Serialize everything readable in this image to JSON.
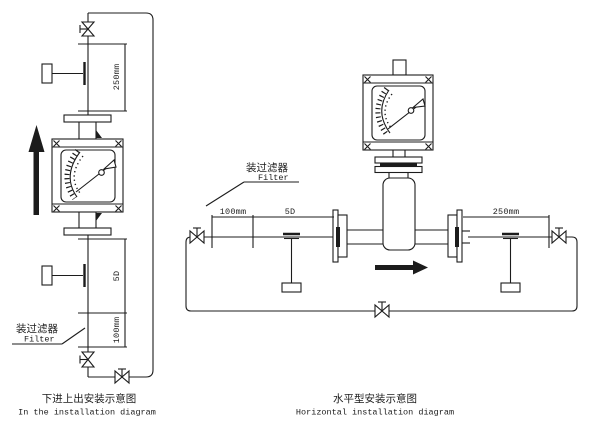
{
  "figure": {
    "type": "flow-meter installation diagram",
    "background": "#ffffff",
    "line_color": "#1c1c1c"
  },
  "left_diagram": {
    "dimensions": {
      "outlet_250": "250mm",
      "inlet_straight_5d": "5D",
      "filter_section_100": "100mm"
    },
    "filter_label": {
      "cn": "装过滤器",
      "en": "Filter"
    },
    "caption": {
      "cn": "下进上出安装示意图",
      "en": "In the installation diagram"
    }
  },
  "right_diagram": {
    "dimensions": {
      "inlet_filter_100": "100mm",
      "inlet_straight_5d": "5D",
      "outlet_250": "250mm"
    },
    "filter_label": {
      "cn": "装过滤器",
      "en": "Filter"
    },
    "caption": {
      "cn": "水平型安装示意图",
      "en": "Horizontal installation diagram"
    }
  }
}
